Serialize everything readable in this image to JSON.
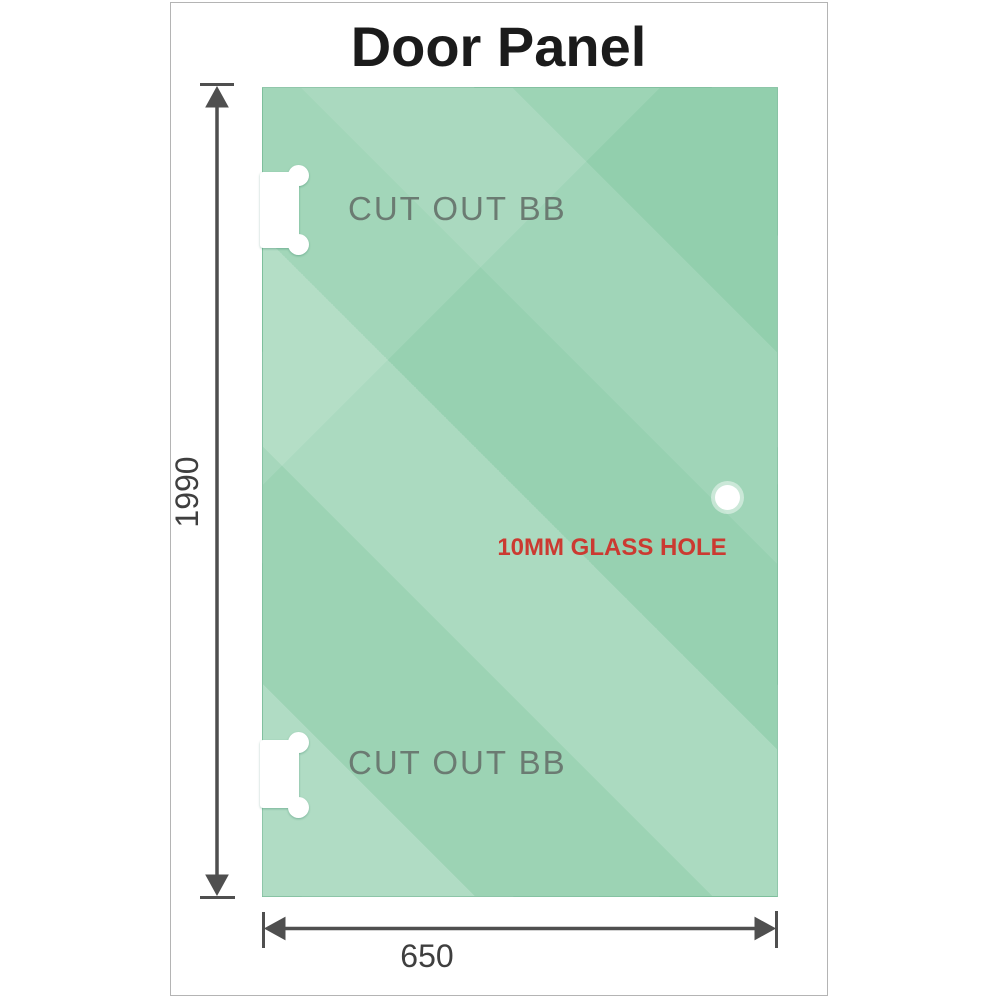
{
  "title": "Door Panel",
  "panel": {
    "cutouts": [
      {
        "label": "CUT OUT BB"
      },
      {
        "label": "CUT OUT BB"
      }
    ],
    "glass_hole": {
      "label": "10MM GLASS HOLE"
    }
  },
  "dimensions": {
    "height": {
      "value": "1990"
    },
    "width": {
      "value": "650"
    }
  },
  "colors": {
    "glass_green": "#8ecdaa",
    "glass_highlight": "#b7e3c8",
    "dimension_gray": "#4f4f4f",
    "hole_label_red": "#cb3a31",
    "cutout_label_gray": "#6b7b72",
    "title_black": "#1b1b1b",
    "frame_border_gray": "#b4b4b4",
    "cutout_white": "#ffffff"
  }
}
